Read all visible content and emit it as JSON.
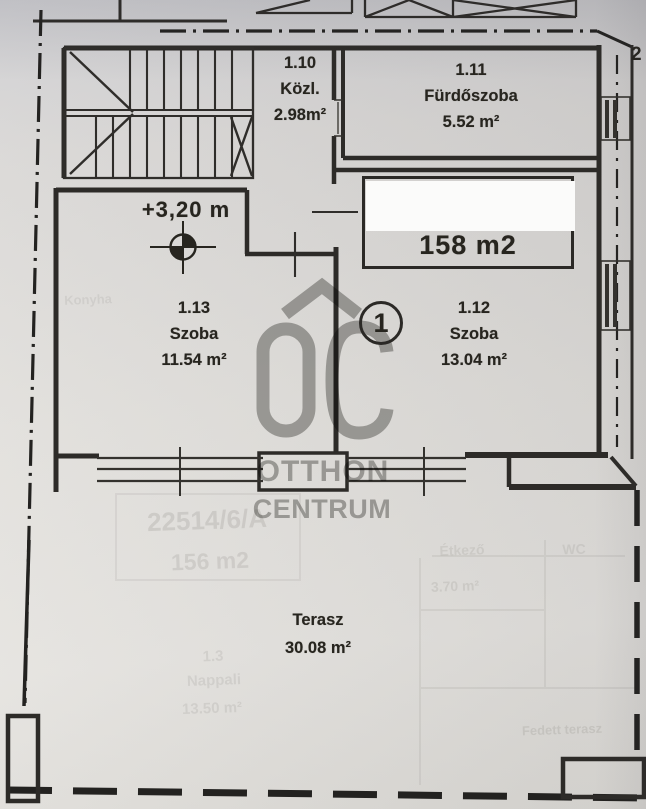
{
  "floorplan": {
    "sheet_marker": "2",
    "unit_number": "1",
    "elevation_marker": "+3,20 m",
    "unit_area_box": {
      "value": "158 m2"
    },
    "rooms": [
      {
        "id": "1.10",
        "name": "Közl.",
        "area": "2.98m²"
      },
      {
        "id": "1.11",
        "name": "Fürdőszoba",
        "area": "5.52 m²"
      },
      {
        "id": "1.12",
        "name": "Szoba",
        "area": "13.04 m²"
      },
      {
        "id": "1.13",
        "name": "Szoba",
        "area": "11.54 m²"
      }
    ],
    "terrace": {
      "name": "Terasz",
      "area": "30.08 m²"
    },
    "watermark": {
      "logo": "ÓC",
      "line1": "OTTHON",
      "line2": "CENTRUM"
    },
    "bleedthrough": {
      "lot_number": "22514/6/A",
      "lot_area": "156 m2",
      "room_id": "1.3",
      "room_name": "Nappali",
      "room_area": "13.50 m²",
      "room2_name": "Étkező",
      "room2_area": "3.70 m²",
      "room3_name": "WC",
      "room4_name": "Fedett terasz",
      "kitchen": "Konyha"
    }
  }
}
